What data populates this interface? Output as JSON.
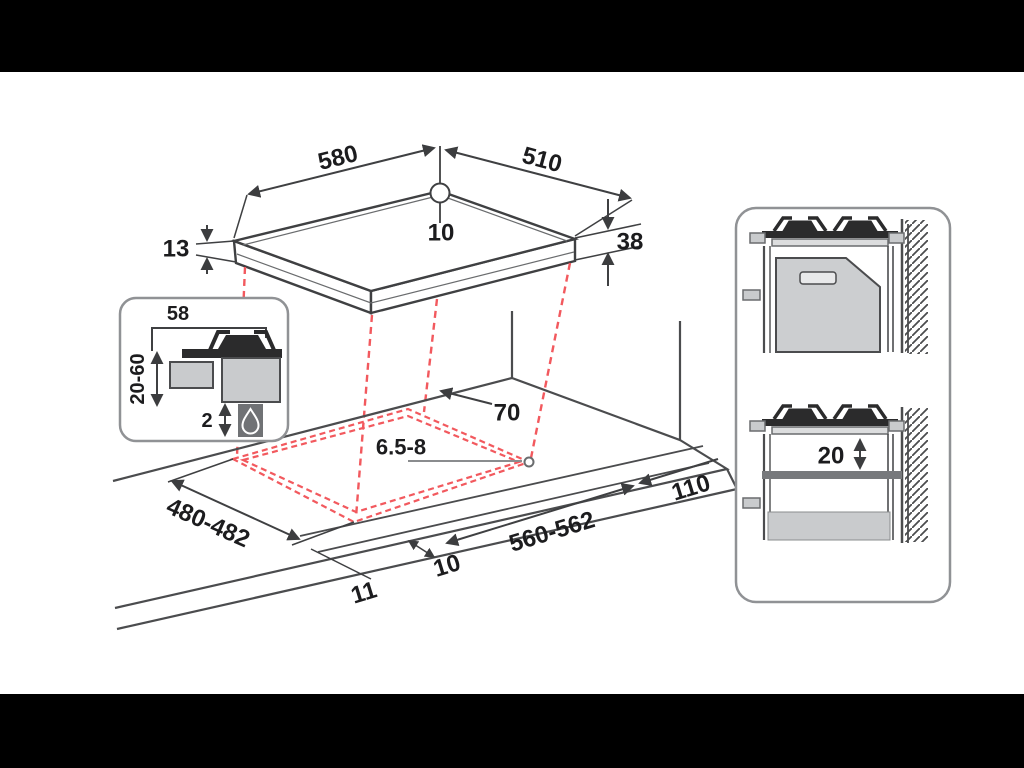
{
  "diagram": {
    "title": "gas hob installation dimensions drawing",
    "hob": {
      "width": "580",
      "depth": "510",
      "hole_offset": "10",
      "front_lip_height": "13",
      "body_height": "38"
    },
    "inset": {
      "burner_edge_distance": "58",
      "under_hob_clearance": "20-60",
      "rear_gap": "2"
    },
    "cutout": {
      "rear_wall_clearance": "70",
      "fixing_hole": "6.5-8",
      "depth": "480-482",
      "width": "560-562",
      "side_wall_clearance": "110",
      "front_edge_offset": "10",
      "worktop_front_edge": "11"
    },
    "side_panel": {
      "shelf_clearance": "20"
    }
  },
  "colors": {
    "ink": "#1c1c1e",
    "line": "#4b4c4e",
    "thin_line": "#6a6c6e",
    "projection_red": "#f2595e",
    "panel_border": "#909295",
    "fill_light": "#c9cbcd",
    "fill_dark": "#2b2b2c",
    "fill_shelf": "#77797c",
    "icon_box": "#707275",
    "letterbox": "#000000"
  }
}
